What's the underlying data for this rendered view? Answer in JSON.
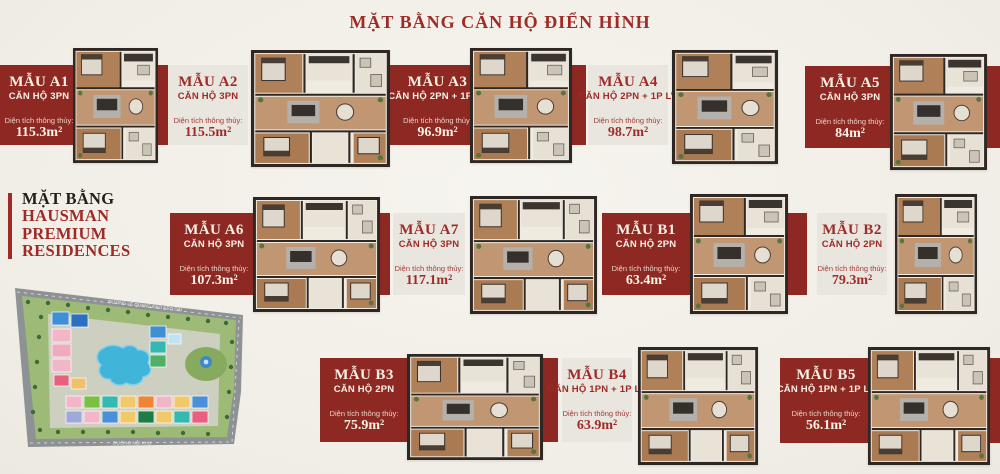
{
  "page": {
    "title": "MẶT BẰNG CĂN HỘ ĐIỂN HÌNH",
    "accent_red": "#8e2823",
    "title_red": "#9e2b26",
    "card_light": "#e9e6e0",
    "card_text_cream": "#f8f1e6",
    "background": "#f3f1ea"
  },
  "brand": {
    "line1": "MẶT BẰNG",
    "line2": "HAUSMAN",
    "line3": "PREMIUM",
    "line4": "RESIDENCES"
  },
  "labels": {
    "area": "Diện tích thông thủy:"
  },
  "units": [
    {
      "id": "A1",
      "name": "MẪU A1",
      "type": "CĂN HỘ 3PN",
      "area": "115.3m²",
      "style": "red"
    },
    {
      "id": "A2",
      "name": "MẪU A2",
      "type": "CĂN HỘ 3PN",
      "area": "115.5m²",
      "style": "light"
    },
    {
      "id": "A3",
      "name": "MẪU A3",
      "type": "CĂN HỘ 2PN + 1P LV",
      "area": "96.9m²",
      "style": "red"
    },
    {
      "id": "A4",
      "name": "MẪU A4",
      "type": "CĂN HỘ 2PN + 1P LV",
      "area": "98.7m²",
      "style": "light"
    },
    {
      "id": "A5",
      "name": "MẪU A5",
      "type": "CĂN HỘ 3PN",
      "area": "84m²",
      "style": "red"
    },
    {
      "id": "A6",
      "name": "MẪU A6",
      "type": "CĂN HỘ 3PN",
      "area": "107.3m²",
      "style": "red"
    },
    {
      "id": "A7",
      "name": "MẪU A7",
      "type": "CĂN HỘ 3PN",
      "area": "117.1m²",
      "style": "light"
    },
    {
      "id": "B1",
      "name": "MẪU B1",
      "type": "CĂN HỘ 2PN",
      "area": "63.4m²",
      "style": "red"
    },
    {
      "id": "B2",
      "name": "MẪU B2",
      "type": "CĂN HỘ 2PN",
      "area": "79.3m²",
      "style": "light"
    },
    {
      "id": "B3",
      "name": "MẪU B3",
      "type": "CĂN HỘ 2PN",
      "area": "75.9m²",
      "style": "red"
    },
    {
      "id": "B4",
      "name": "MẪU B4",
      "type": "CĂN HỘ 1PN + 1P LV",
      "area": "63.9m²",
      "style": "light"
    },
    {
      "id": "B5",
      "name": "MẪU B5",
      "type": "CĂN HỘ 1PN + 1P LV",
      "area": "56.1m²",
      "style": "red"
    }
  ],
  "siteplan": {
    "road_top": "ĐƯỜNG LÊ QUANG ĐẠO KÉO DÀI",
    "road_bottom": "ĐƯỜNG NỘI KHU"
  }
}
